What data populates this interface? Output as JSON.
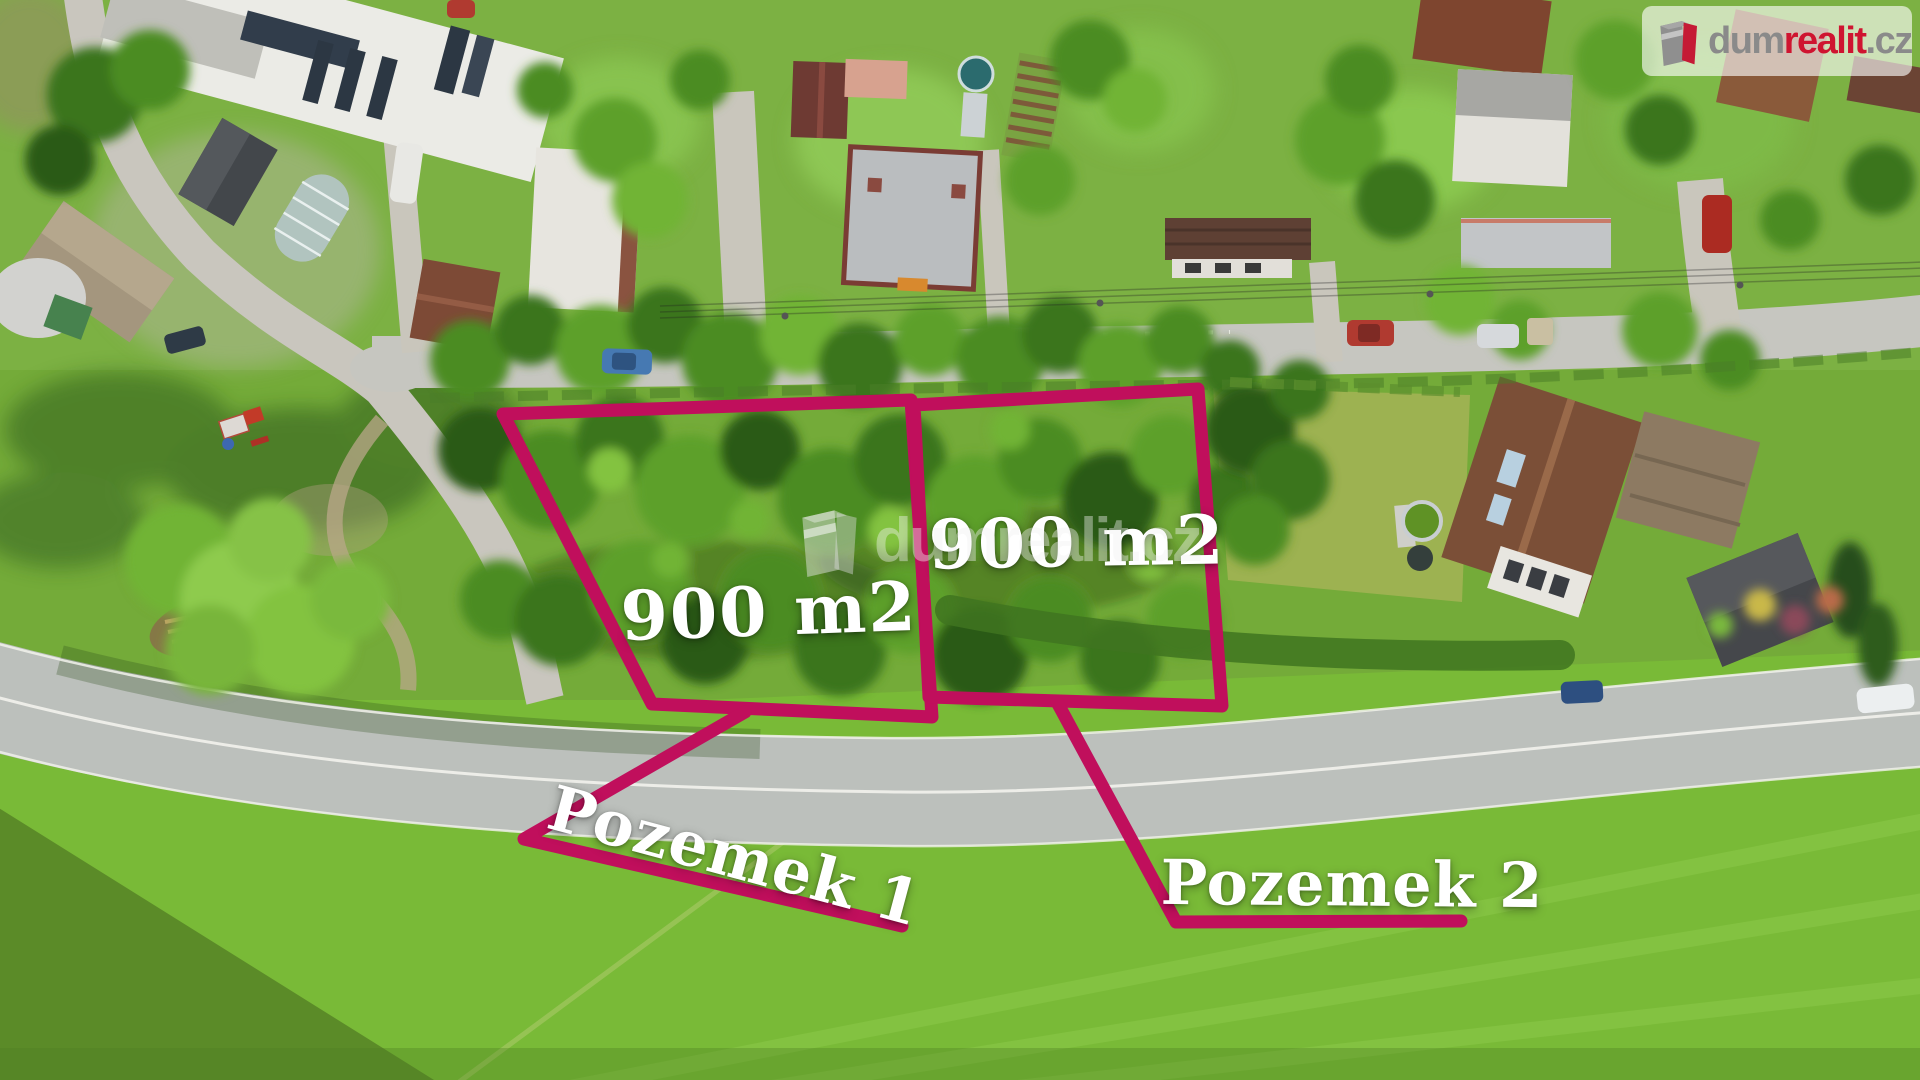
{
  "brand": {
    "watermark_text": "dumrealit.cz",
    "logo": {
      "part_dum": "dum",
      "part_realit": "realit",
      "part_cz": ".cz"
    },
    "logo_gray_color": "#8a8a8a",
    "logo_red_color": "#cf1430"
  },
  "annotations": {
    "outline_color": "#c00f5c",
    "label_color": "#ffffff",
    "plot1": {
      "area_label": "900 m2",
      "name_label": "Pozemek 1"
    },
    "plot2": {
      "area_label": "900 m2",
      "name_label": "Pozemek 2"
    }
  }
}
